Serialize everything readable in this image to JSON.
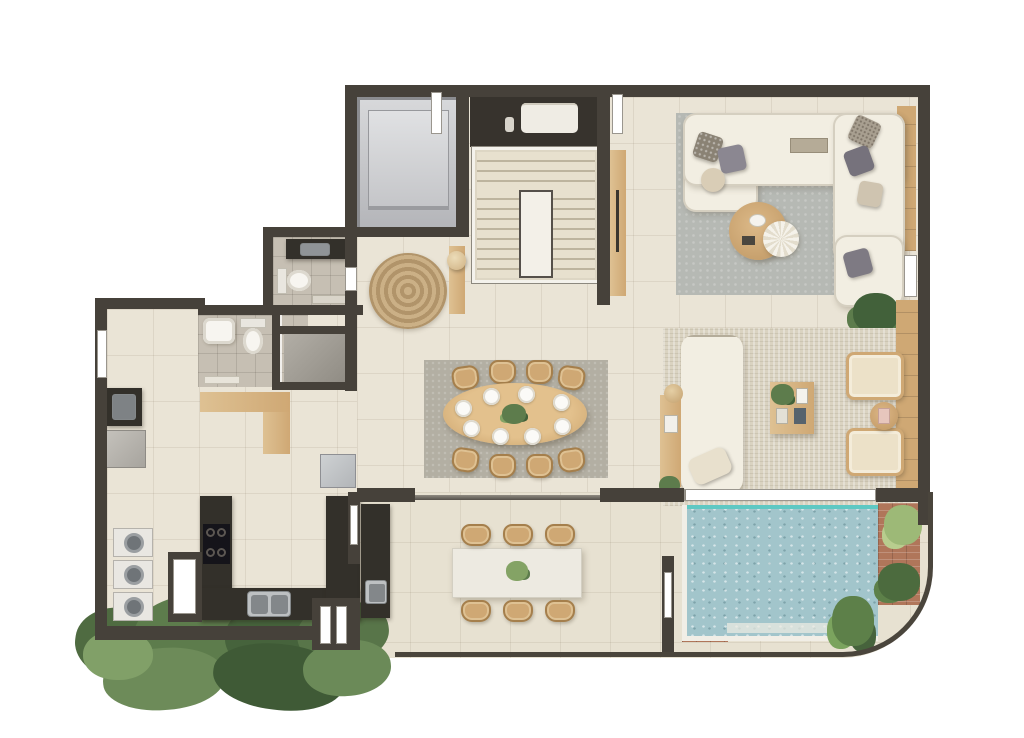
{
  "scene": {
    "kind": "residential-apartment-floor-plan",
    "view": "3d-top-down-render",
    "visible_text": "none"
  },
  "palette": {
    "wall": "#46413a",
    "wall2": "#37332d",
    "floor": "#eae4d6",
    "terrace": "#e7e1d1",
    "bath": "#c6bfb3",
    "gray_room": "#a29e96",
    "elevator": "#cdcfd2",
    "wood": "#cfa874",
    "wood2": "#dec193",
    "rug_living": "#b6b9b4",
    "rug_lounge": "#dad3c1",
    "rug_dining": "#b3afa3",
    "rug_jute": "#c2a67c",
    "sofa": "#f2eee2",
    "cushion": "#8a8590",
    "counter": "#33302a",
    "steel": "#bdc0c2",
    "pool": "#a2c5cb",
    "waterline": "#5fc8c3",
    "brick": "#b0765a",
    "marble": "#edeae1",
    "plant1": "#5d7c4c",
    "plant2": "#42613a",
    "plant3": "#84a365",
    "white": "#f7f5f0"
  },
  "rooms": [
    "elevator",
    "linen-closet",
    "staircase",
    "foyer",
    "living-room",
    "lounge",
    "dining-room",
    "kitchen",
    "laundry",
    "bathroom",
    "powder-room",
    "storage",
    "gourmet-terrace",
    "pool-deck"
  ],
  "counts": {
    "dining_chairs": 8,
    "dining_place_settings": 8,
    "terrace_chairs": 6,
    "lounge_armchairs": 2,
    "living_sofa_pieces": 3,
    "washer_dryer_units": 3,
    "cooktop_burners": 4,
    "kitchen_sink_basins": 2,
    "stair_flights": 2,
    "toilets": 2,
    "pools": 1,
    "terrace_plants": 3,
    "tree_clusters_outside": 1
  }
}
